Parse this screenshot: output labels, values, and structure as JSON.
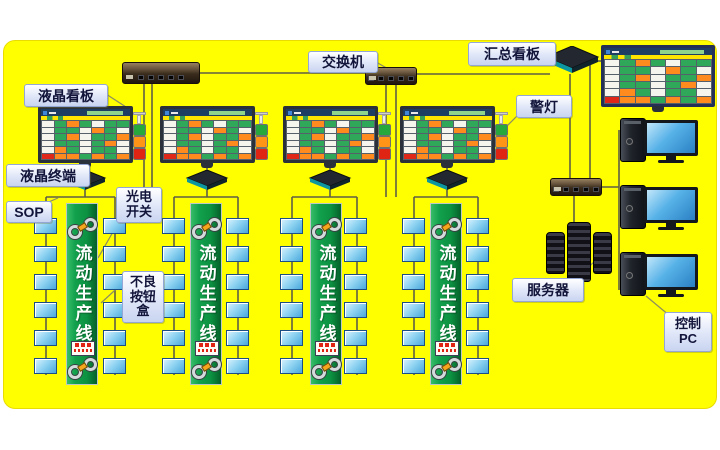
{
  "canvas_bg": "#ffff00",
  "labels": {
    "lcd_board": "液晶看板",
    "lcd_terminal": "液晶终端",
    "sop": "SOP",
    "photo_switch": "光电\n开关",
    "defect_button_box": "不良\n按钮\n盒",
    "switch": "交换机",
    "summary_board": "汇总看板",
    "alarm_light": "警灯",
    "server": "服务器",
    "control_pc": "控制\nPC"
  },
  "production_line": {
    "banner_label": "流动生产线",
    "line_count": 4,
    "stations_per_column": 6
  },
  "screen": {
    "pattern": [
      "wgogwgg",
      "wggwogw",
      "wgowggo",
      "wggwgow",
      "wogwggw",
      "roogogo"
    ],
    "colors": {
      "g": "#2fa85a",
      "w": "#f5f5ee",
      "o": "#ff8a1e",
      "r": "#e02818"
    },
    "header_color": "#ffe400",
    "titlebar_color": "#1d3d63"
  },
  "status_light_colors": {
    "top": "#27a83c",
    "middle": "#ff9416",
    "bottom": "#e02414"
  }
}
